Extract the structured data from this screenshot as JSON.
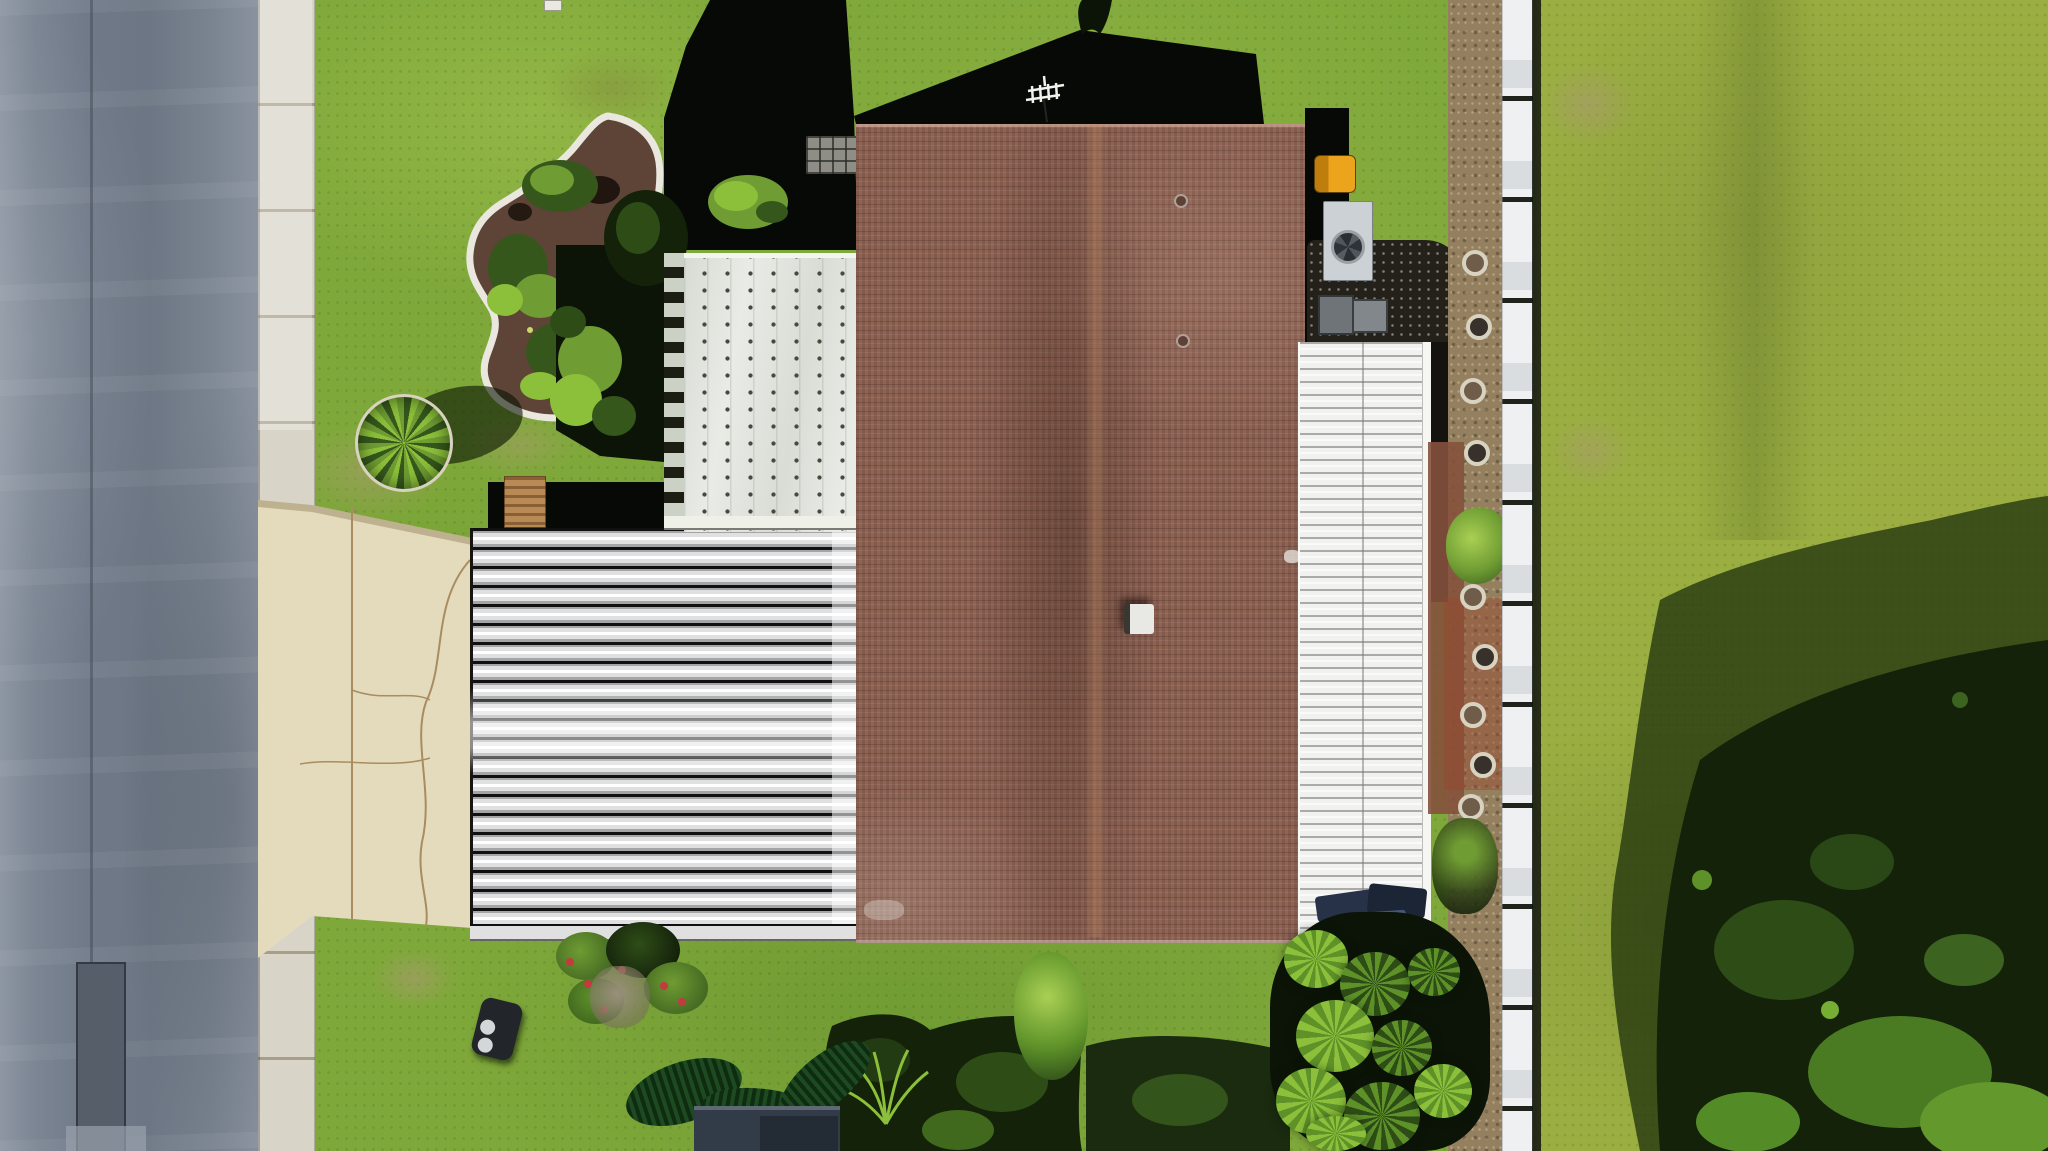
{
  "scene": {
    "type": "aerial-drone-photo",
    "subject": "single-family home with brown shingle roof, white metal carport and lanai roofs, concrete driveway, street at left, white fence and large trees at right, tropical landscaping",
    "objects": [
      "asphalt-road",
      "concrete-sidewalk",
      "front-lawn",
      "mulch-garden-bed",
      "round-plant-bed",
      "concrete-driveway",
      "corrugated-carport-roof",
      "screened-panel-roof",
      "brown-shingle-roof",
      "tv-antenna",
      "house-shadow",
      "lanai-slat-roof",
      "ac-unit",
      "yellow-barrel",
      "utility-bins",
      "gravel-bed",
      "stepping-stone-pavers",
      "white-fence",
      "dirt-path",
      "side-yard-grass",
      "large-tree-canopy",
      "palm-fronds",
      "schefflera-plant",
      "garden-shed",
      "grill",
      "bench",
      "patio-gear",
      "flower-shrubs",
      "planter-pot"
    ]
  },
  "palette": {
    "road": "#6f7988",
    "road-seam": "#3e4450",
    "road-patch": "#565e6a",
    "sidewalk": "#d8d5c8",
    "sidewalk-seam": "#a89f88",
    "driveway": "#e4dbbd",
    "driveway-crack": "#a98c60",
    "grass": "#7fa83a",
    "right-grass": "#9aae41",
    "patch-tan": "#a99a6e",
    "dirt": "#94805f",
    "dirt-red": "#84513c",
    "gravel": "#24211b",
    "mulch": "#5d4437",
    "bed-edge": "#eae8de",
    "shingle": "#8f6455",
    "shingle-dark": "#5f4034",
    "shingle-streak": "#c08a66",
    "metal-hi": "#ffffff",
    "metal-mid": "#e0e0e1",
    "metal-low": "#a3a5a6",
    "metal-gap": "#101010",
    "panel": "#e9ece6",
    "panel-dot": "#4a473c",
    "panel-trim-light": "#ccd1c5",
    "panel-trim-dark": "#1c1e14",
    "porch": "#f1f1ef",
    "fence": "#eef0f2",
    "fence-mid": "#d9dde0",
    "fence-gap": "#20221c",
    "fence-shadow": "#12150f",
    "shadow": "#070906",
    "foliage-dark": "#0c1408",
    "canopy": "#132209",
    "canopy-mid": "#2e4d16",
    "leaf": "#5e9229",
    "leaf-bright": "#8cbf3a",
    "leaf-lime": "#a9d054",
    "bush": "#6f9c33",
    "bush-dark": "#35571c",
    "frond-dark": "#0e2c10",
    "frond-mid": "#1d4a20",
    "ac": "#ccd1d5",
    "ac-fan": "#3e444a",
    "ac-ring": "#9aa0a6",
    "barrel": "#eca41c",
    "barrel-dark": "#bf7d0e",
    "bin": "#6f7478",
    "bin2": "#82878b",
    "navy": "#273248",
    "navy-dark": "#1b2535",
    "paver-ring": "#d8d2c0",
    "paver-center": "#6f5c49",
    "paver-dark": "#38302a",
    "stone": "#9a917c",
    "flower": "#c43a3e",
    "bench": "#b98a54",
    "pot-ring": "#c9b089",
    "pot": "#473a2b",
    "shed": "#323c48",
    "shed-dark": "#232b35",
    "shed-light": "#5e6974",
    "grill": "#22262b",
    "grill-dot": "#d3d7da",
    "marker": "#e9e9e1",
    "antenna": "#f2f2ec"
  }
}
